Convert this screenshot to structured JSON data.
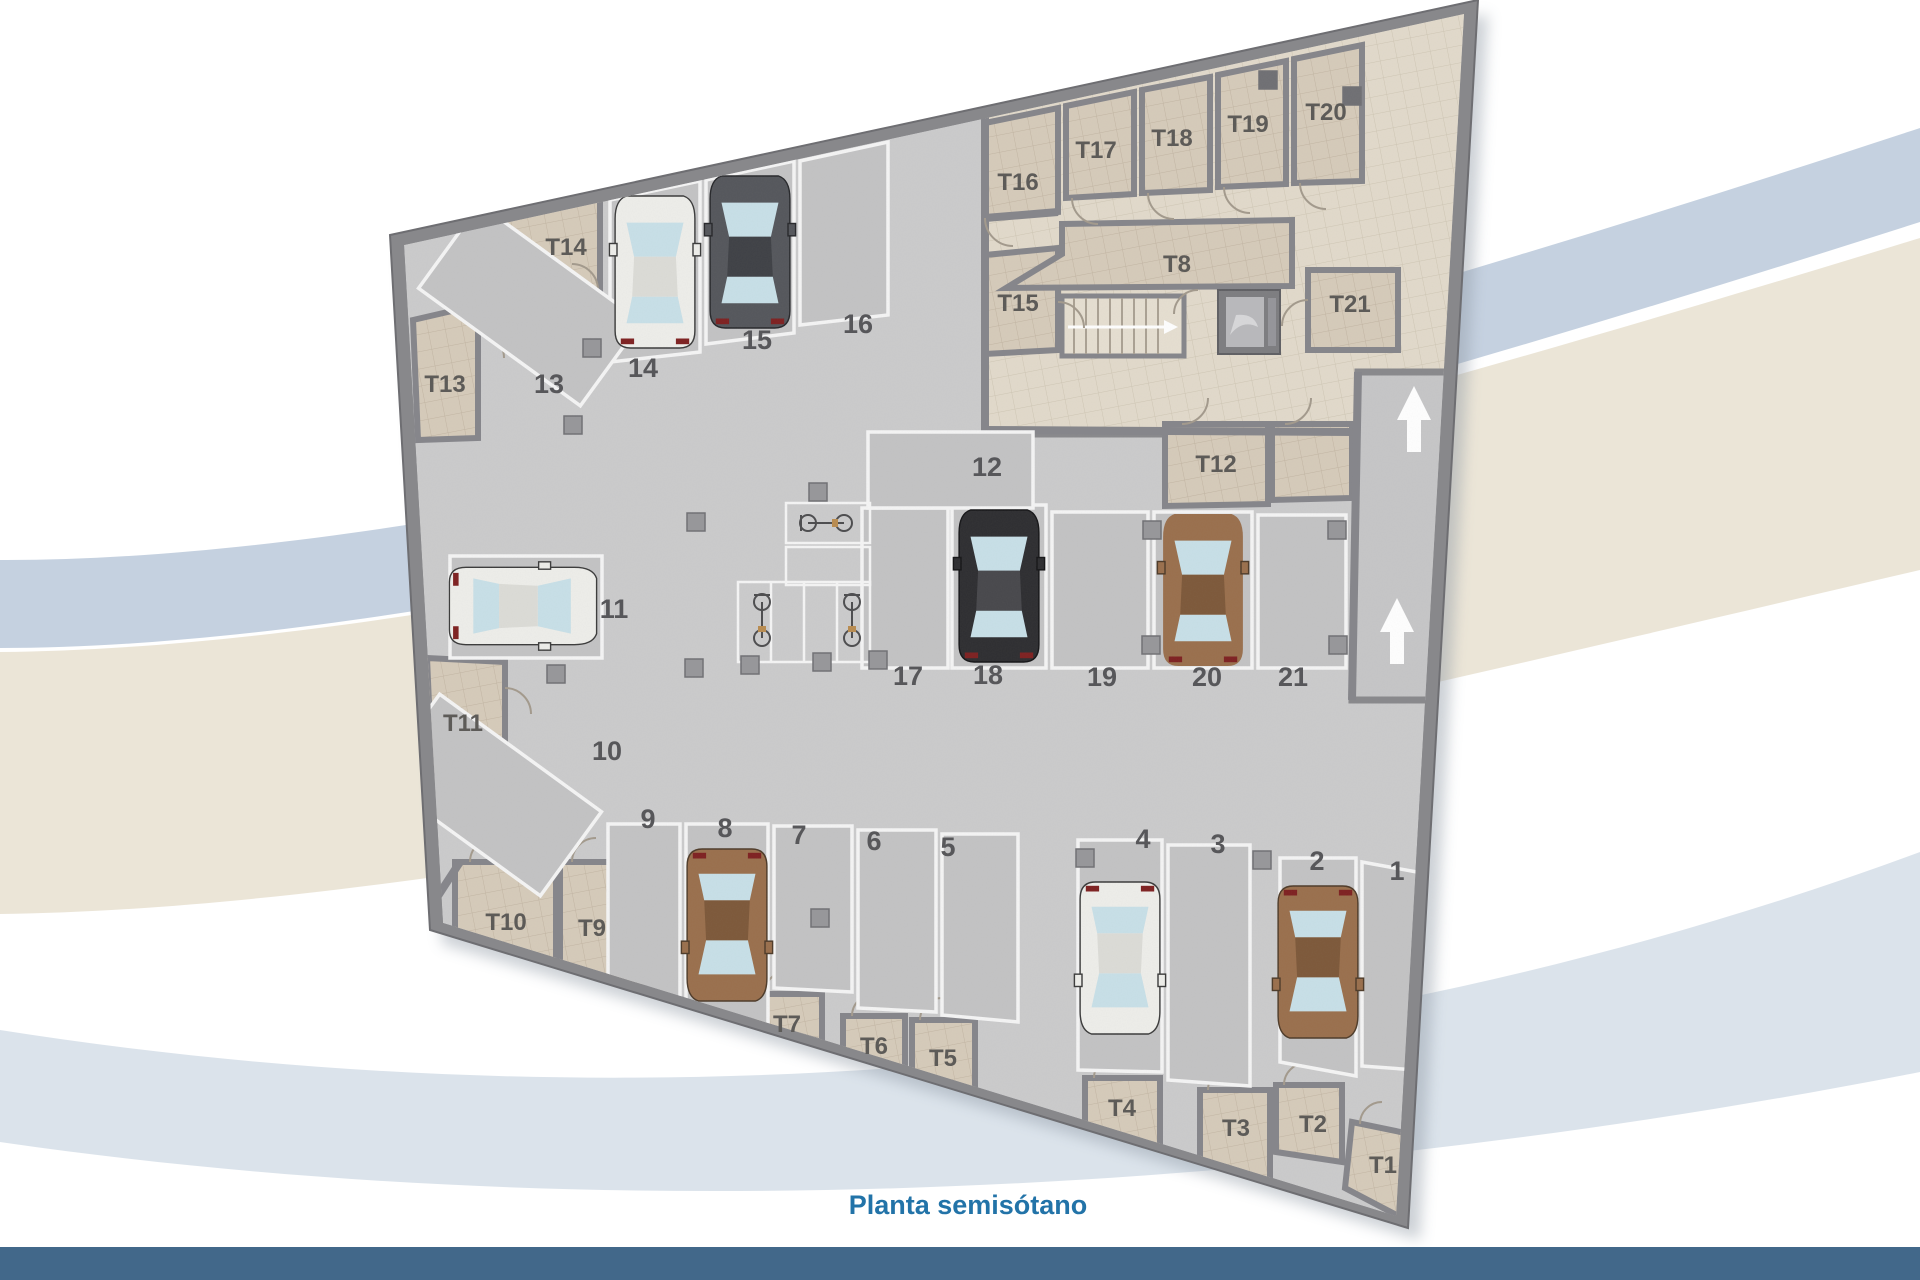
{
  "title": "Planta semisótano",
  "colors": {
    "title": "#2273a8",
    "bottom_bar": "#42688a",
    "wall": "#88888b",
    "floor": "#cbcbcc",
    "tile_room": "#d6cbba",
    "tile_corridor": "#e2dacb",
    "parking_outline": "#f5f5f5",
    "label": "#57575a"
  },
  "icons": {
    "ramp_direction": "up-arrow",
    "stairs_direction": "right-arrow"
  },
  "plan": {
    "parking_labels": [
      "1",
      "2",
      "3",
      "4",
      "5",
      "6",
      "7",
      "8",
      "9",
      "10",
      "11",
      "12",
      "13",
      "14",
      "15",
      "16",
      "17",
      "18",
      "19",
      "20",
      "21"
    ],
    "storage_labels": [
      "T1",
      "T2",
      "T3",
      "T4",
      "T5",
      "T6",
      "T7",
      "T8",
      "T9",
      "T10",
      "T11",
      "T12",
      "T13",
      "T14",
      "T15",
      "T16",
      "T17",
      "T18",
      "T19",
      "T20",
      "T21"
    ]
  }
}
